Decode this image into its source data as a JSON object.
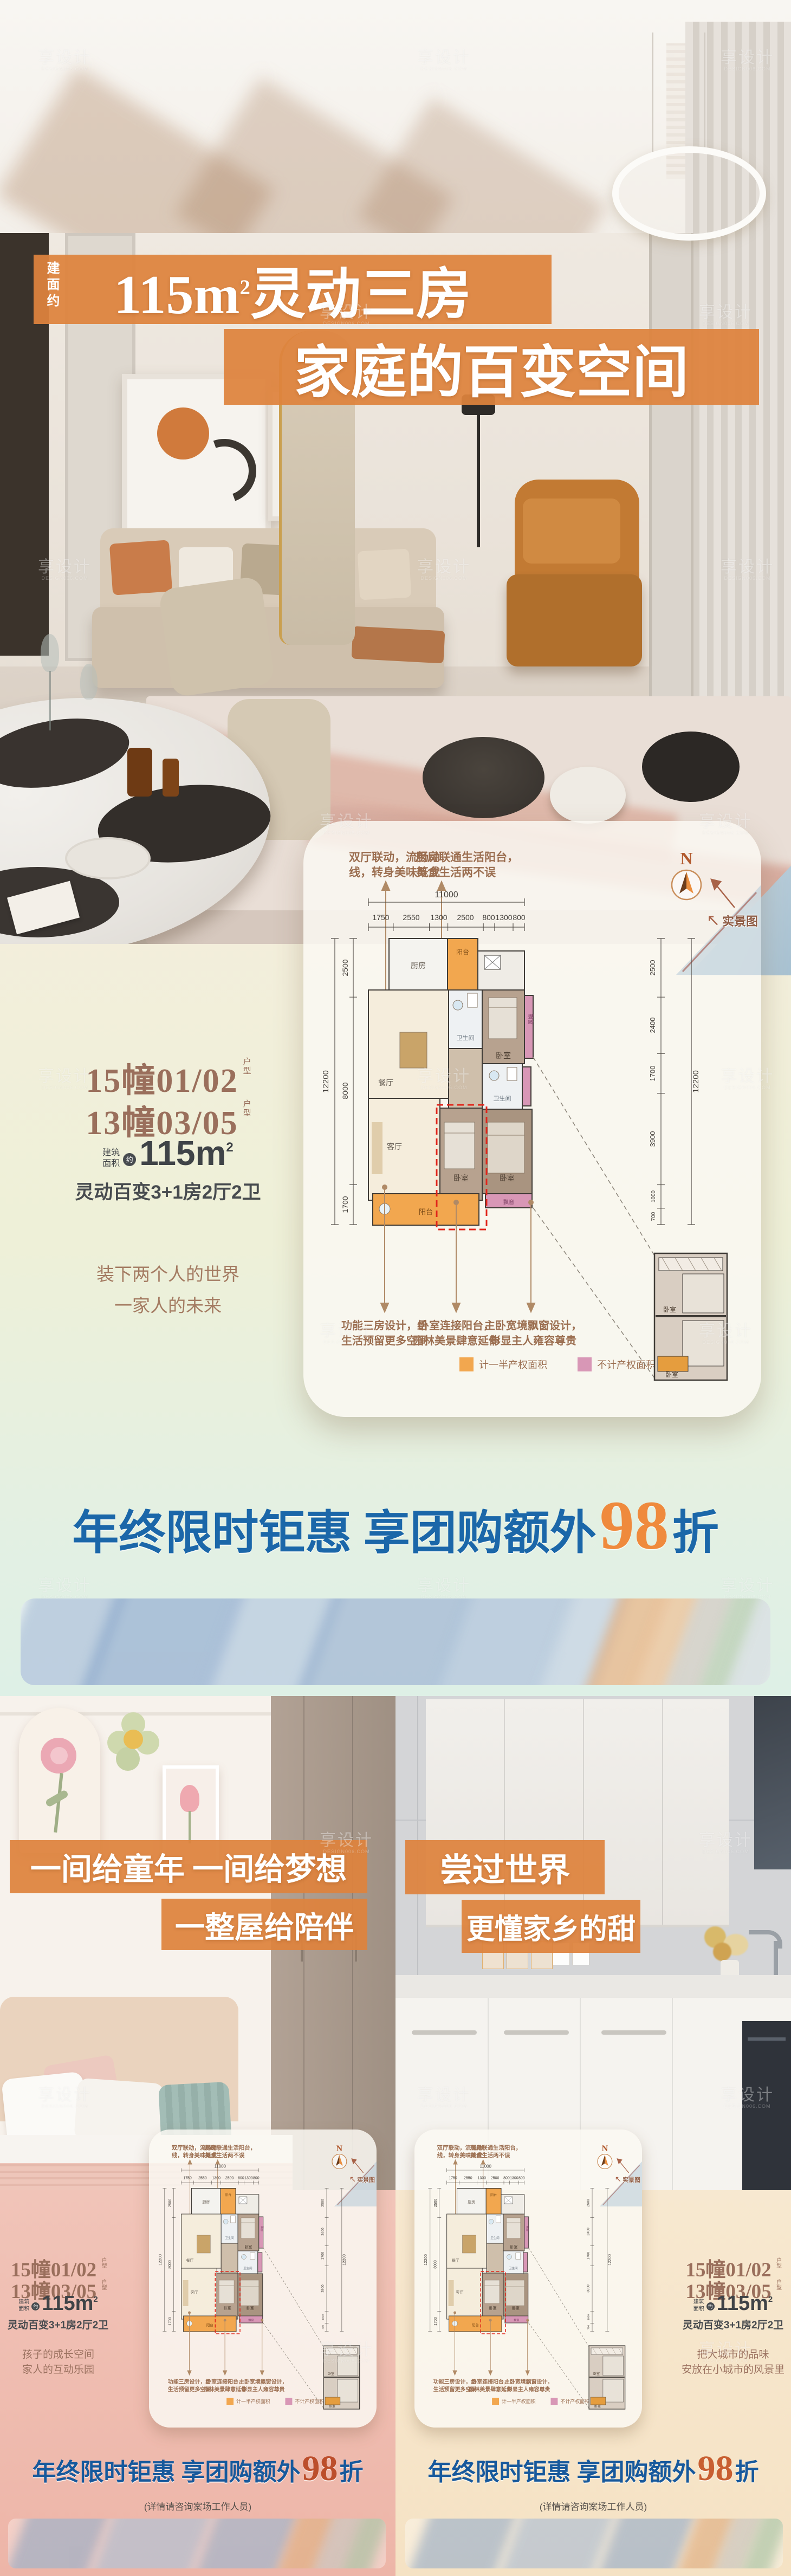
{
  "watermark": {
    "text": "享设计",
    "sub": "DESIGN006.COM"
  },
  "shared": {
    "unit_line1": "15幢01/02",
    "unit_line2": "13幢03/05",
    "unit_suffix": "户型",
    "area_label1": "建筑",
    "area_label2": "面积",
    "area_approx": "约",
    "area_value": "115m",
    "area_sup": "2",
    "layout_text": "灵动百变3+1房2厅2卫",
    "promo_prefix": "年终限时钜惠 享团购额外",
    "promo_number": "98",
    "promo_suffix": "折",
    "note": "(详情请咨询案场工作人员)"
  },
  "poster_main": {
    "title_prefix_vertical": "建面约",
    "title_num": "115m",
    "title_sup": "2",
    "title_rest": "灵动三房",
    "title_line2": "家庭的百变空间",
    "slogan_line1": "装下两个人的世界",
    "slogan_line2": "一家人的未来"
  },
  "poster_left": {
    "title_line1": "一间给童年 一间给梦想",
    "title_line2": "一整屋给陪伴",
    "slogan_line1": "孩子的成长空间",
    "slogan_line2": "家人的互动乐园"
  },
  "poster_right": {
    "title_line1": "尝过世界",
    "title_line2": "更懂家乡的甜",
    "slogan_line1": "把大城市的品味",
    "slogan_line2": "安放在小城市的风景里"
  },
  "floorplan": {
    "ann_top1_l1": "双厅联动，流畅动",
    "ann_top1_l2": "线，转身美味既成",
    "ann_top2_l1": "厨房联通生活阳台，",
    "ann_top2_l2": "美食生活两不误",
    "compass": "N",
    "scene_label": "实景图",
    "dims_top_total": "11000",
    "dims_top": [
      "1750",
      "2550",
      "1300",
      "2500",
      "800",
      "1300",
      "800"
    ],
    "dims_left": [
      "2500",
      "8000",
      "1700"
    ],
    "dims_left_total": "12200",
    "dims_right": [
      "2500",
      "2400",
      "1700",
      "3900",
      "1000",
      "700"
    ],
    "dims_right_total": "12200",
    "dims_bottom": [
      "3900",
      "250",
      "2800",
      "3450"
    ],
    "dims_bottom_total": "10400",
    "rooms": {
      "balcony_top": "阳台",
      "kitchen": "厨房",
      "dining": "餐厅",
      "bath1": "卫生间",
      "bed_top": "卧室",
      "bay": "飘窗",
      "bath2": "卫生间",
      "living": "客厅",
      "bed_mid": "卧室",
      "master": "卧室",
      "bay2": "飘窗",
      "balcony": "阳台"
    },
    "ann_b1_l1": "功能三房设计，给",
    "ann_b1_l2": "生活预留更多空间",
    "ann_b2_l1": "卧室连接阳台，",
    "ann_b2_l2": "园林美景肆意延伸",
    "ann_b3_l1": "主卧宽境飘窗设计，",
    "ann_b3_l2": "彰显主人雍容尊贵",
    "legend1": "计一半产权面积",
    "legend2": "不计产权面积",
    "inset_room1": "卧室",
    "inset_room2": "卧室"
  },
  "colors": {
    "banner_orange": "#de833d",
    "promo_blue": "#1b67a9",
    "promo_orange": "#ef8a3d",
    "promo_red": "#bc4e2b",
    "legend_half_area": "#f2a74f",
    "legend_no_area": "#d897b6",
    "text_brown": "#9b6e50"
  }
}
